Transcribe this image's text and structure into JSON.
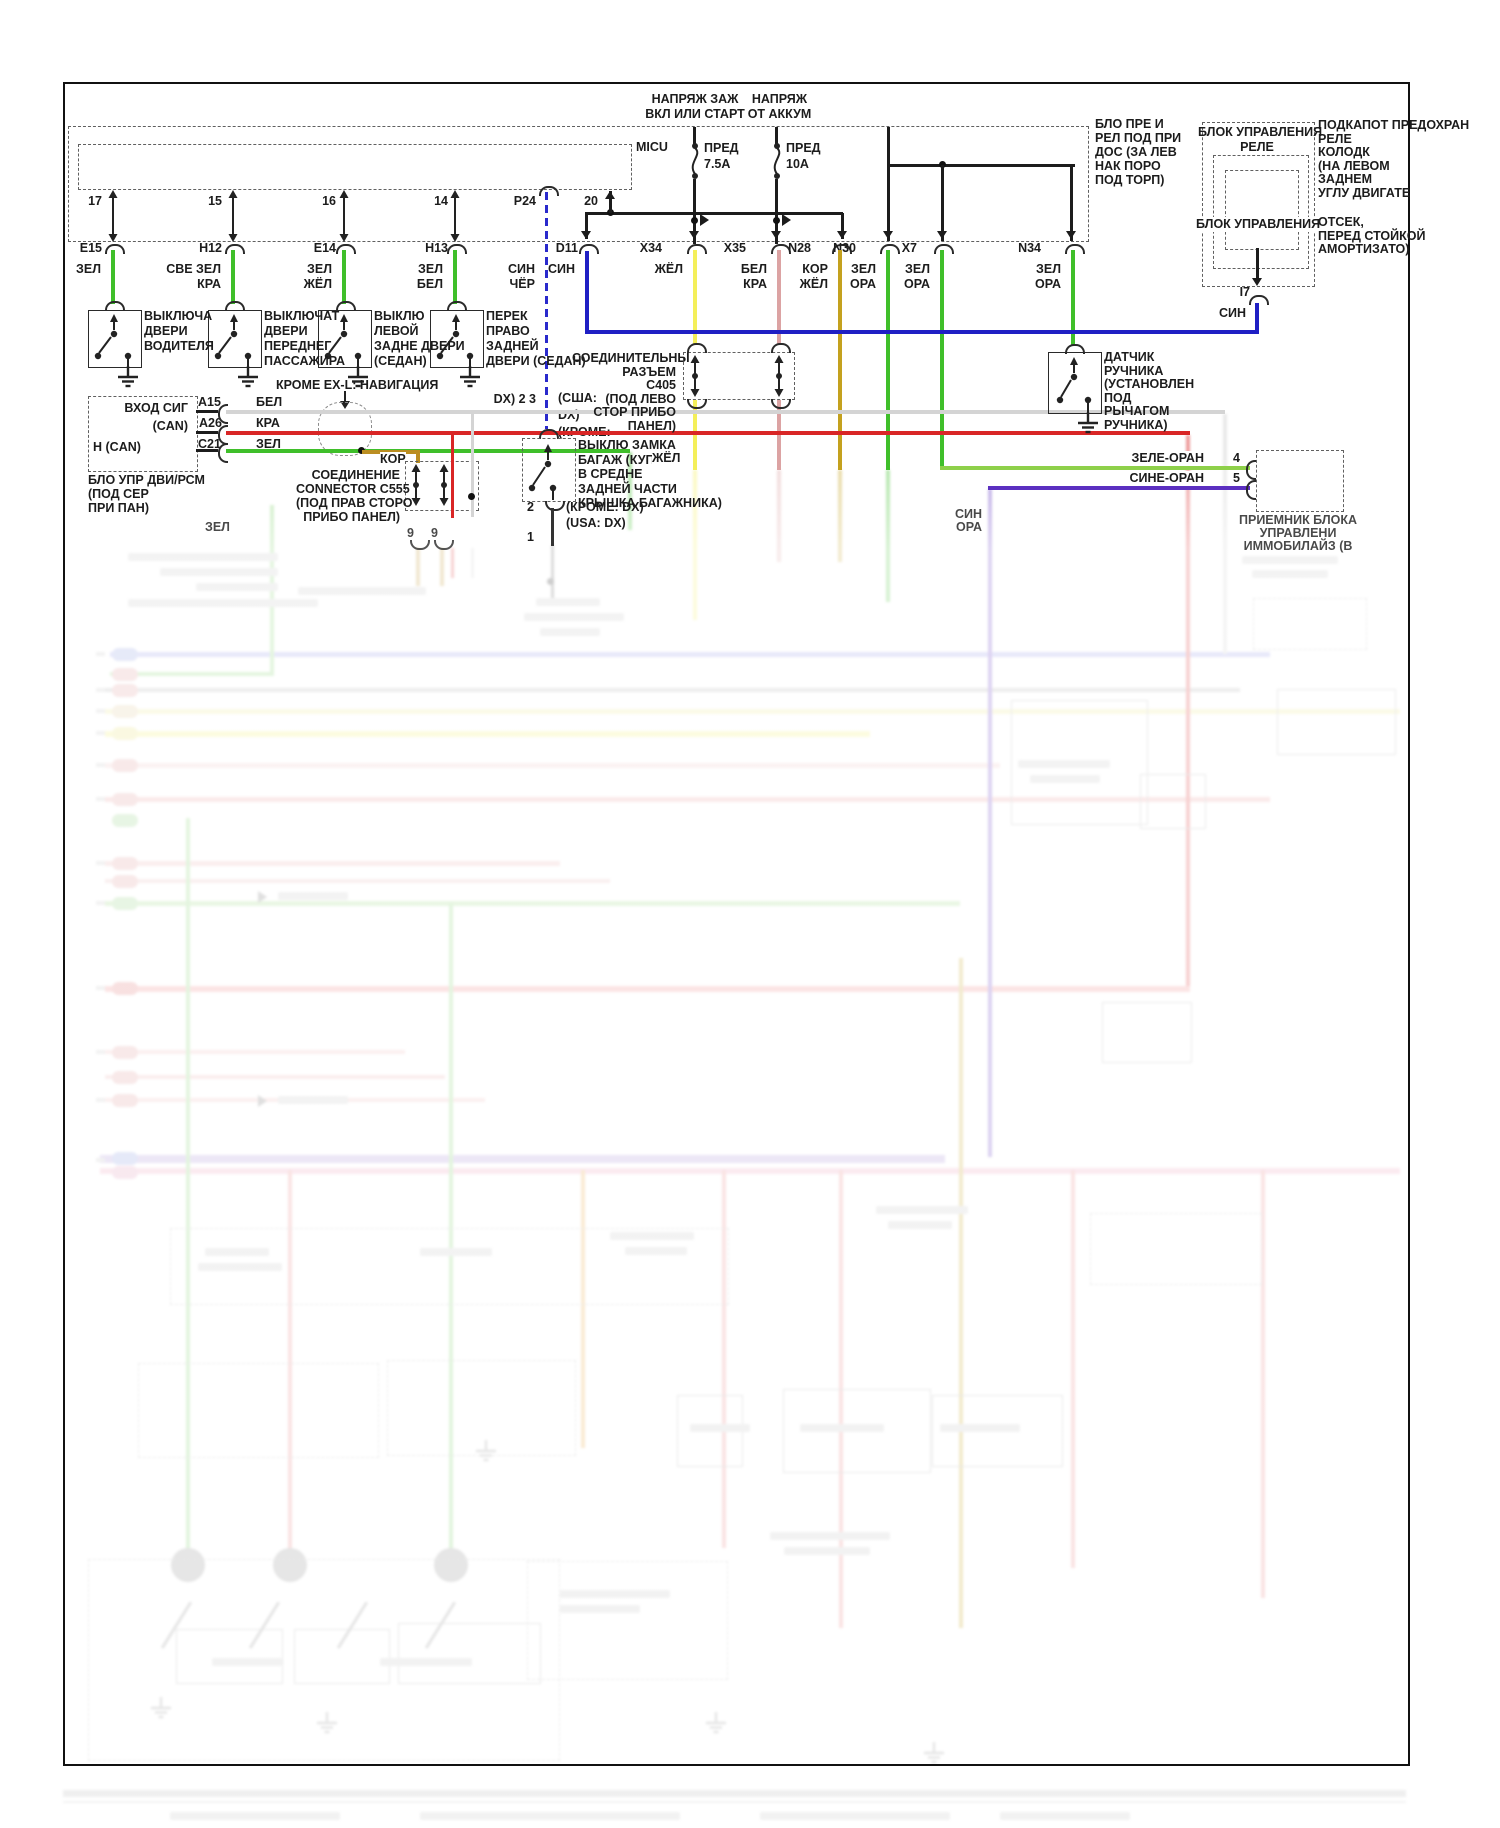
{
  "power": {
    "ignition_lines": [
      "НАПРЯЖ ЗАЖ",
      "ВКЛ ИЛИ СТАРТ"
    ],
    "battery_lines": [
      "НАПРЯЖ",
      "ОТ АККУМ"
    ],
    "fuse1_name": "ПРЕД",
    "fuse1_rating": "7.5А",
    "fuse2_name": "ПРЕД",
    "fuse2_rating": "10А"
  },
  "boxes": {
    "micu": "MICU",
    "underdash_lines": [
      "БЛО ПРЕ И",
      "РЕЛ ПОД ПРИ",
      "ДОС (ЗА ЛЕВ",
      "НАК ПОРО",
      "ПОД ТОРП)"
    ],
    "relay_title_lines": [
      "БЛОК УПРАВЛЕНИЯ",
      "РЕЛЕ"
    ],
    "relay_inner": "БЛОК УПРАВЛЕНИЯ",
    "relay_note1_lines": [
      "ПОДКАПОТ ПРЕДОХРАН",
      "РЕЛЕ",
      "КОЛОДК",
      "(НА ЛЕВОМ",
      "ЗАДНЕМ",
      "УГЛУ ДВИГАТЕ"
    ],
    "relay_note2_lines": [
      "ОТСЕК,",
      "ПЕРЕД СТОЙКОЙ",
      "АМОРТИЗАТО)"
    ],
    "relay_pin": "I7",
    "relay_pin_color": "СИН"
  },
  "micu_pins": [
    "17",
    "15",
    "16",
    "14",
    "P24",
    "20"
  ],
  "p24": {
    "wire_color_lines": [
      "СИН",
      "ЧЁР"
    ],
    "note_left": "DX) 2 3",
    "note_right_lines": [
      "(США:",
      "DX)",
      "(КРОМЕ:"
    ]
  },
  "connectors": [
    {
      "id": "E15",
      "c": [
        "ЗЕЛ"
      ]
    },
    {
      "id": "H12",
      "c": [
        "СВЕ ЗЕЛ",
        "КРА"
      ]
    },
    {
      "id": "E14",
      "c": [
        "ЗЕЛ",
        "ЖЁЛ"
      ]
    },
    {
      "id": "H13",
      "c": [
        "ЗЕЛ",
        "БЕЛ"
      ]
    },
    {
      "id": "D11",
      "c": [
        "СИН"
      ]
    },
    {
      "id": "X34",
      "c": [
        "ЖЁЛ"
      ]
    },
    {
      "id": "X35",
      "c": [
        "БЕЛ",
        "КРА"
      ]
    },
    {
      "id": "N28",
      "c": [
        "КОР",
        "ЖЁЛ"
      ]
    },
    {
      "id": "N30",
      "c": [
        "ЗЕЛ",
        "ОРА"
      ]
    },
    {
      "id": "X7",
      "c": [
        "ЗЕЛ",
        "ОРА"
      ]
    },
    {
      "id": "N34",
      "c": [
        "ЗЕЛ",
        "ОРА"
      ]
    }
  ],
  "door_switches": [
    {
      "label_lines": [
        "ВЫКЛЮЧА",
        "ДВЕРИ",
        "ВОДИТЕЛЯ"
      ]
    },
    {
      "label_lines": [
        "ВЫКЛЮЧАТ",
        "ДВЕРИ",
        "ПЕРЕДНЕГ",
        "ПАССАЖИРА"
      ]
    },
    {
      "label_lines": [
        "ВЫКЛЮ",
        "ЛЕВОЙ",
        "ЗАДНЕ ДВЕРИ",
        "(СЕДАН)"
      ]
    },
    {
      "label_lines": [
        "ПЕРЕК",
        "ПРАВО",
        "ЗАДНЕЙ",
        "ДВЕРИ (СЕДАН)"
      ]
    }
  ],
  "nav_note": "КРОМЕ EX-L: НАВИГАЦИЯ",
  "ecm": {
    "sig_label": "ВХОД СИГ",
    "can_label": "(CAN)",
    "hcan_label": "H (CAN)",
    "pins": [
      {
        "id": "A15",
        "color": "БЕЛ"
      },
      {
        "id": "A26",
        "color": "КРА"
      },
      {
        "id": "C21",
        "color": "ЗЕЛ"
      }
    ],
    "caption_lines": [
      "БЛО УПР ДВИ/РСМ",
      "(ПОД СЕР",
      "ПРИ ПАН)"
    ],
    "green_label": "ЗЕЛ"
  },
  "c555": {
    "kor": "КОР",
    "caption_lines": [
      "СОЕДИНЕНИЕ",
      "CONNECTOR C555",
      "(ПОД ПРАВ СТОРО",
      "ПРИБО ПАНЕЛ)"
    ],
    "pins": [
      "9",
      "9"
    ]
  },
  "c405": {
    "caption_lines": [
      "СОЕДИНИТЕЛЬНЫ",
      "РАЗЪЕМ",
      "С405",
      "(ПОД ЛЕВО",
      "СТОР ПРИБО",
      "ПАНЕЛ)"
    ]
  },
  "trunk": {
    "caption_lines": [
      "ВЫКЛЮ ЗАМКА",
      "БАГАЖ (КУПЕ:",
      "В СРЕДНЕ",
      "ЗАДНЕЙ ЧАСТИ",
      "КРЫШКА БАГАЖНИКА)"
    ],
    "wire_color": "ЖЁЛ",
    "pin2": "2",
    "note2": "(КРОМЕ: DX)",
    "pin1": "1",
    "note1": "(USA: DX)"
  },
  "handbrake": {
    "caption_lines": [
      "ДАТЧИК",
      "РУЧНИКА",
      "(УСТАНОВЛЕН",
      "ПОД",
      "РЫЧАГОМ",
      "РУЧНИКА)"
    ]
  },
  "immobilizer": {
    "wire4": "ЗЕЛЕ-ОРАН",
    "pin4": "4",
    "wire5": "СИНЕ-ОРАН",
    "pin5": "5",
    "caption_lines": [
      "ПРИЕМНИК БЛОКА",
      "УПРАВЛЕНИ",
      "ИММОБИЛАЙЗ (В"
    ],
    "wire_down_lines": [
      "СИН",
      "ОРА"
    ]
  },
  "wire_colors": {
    "green": "#3fbf2a",
    "light_green": "#7ed06a",
    "yellow": "#f4ef5a",
    "blue": "#1f1fc4",
    "dashed_blue": "#2a2acc",
    "white": "#d4d4d4",
    "red": "#d92626",
    "pale_pink": "#dca3a3",
    "brown_yellow": "#c4a11e",
    "gold": "#bb8e22",
    "purple": "#5b2fc0",
    "green_orange": "#8ed04a"
  }
}
